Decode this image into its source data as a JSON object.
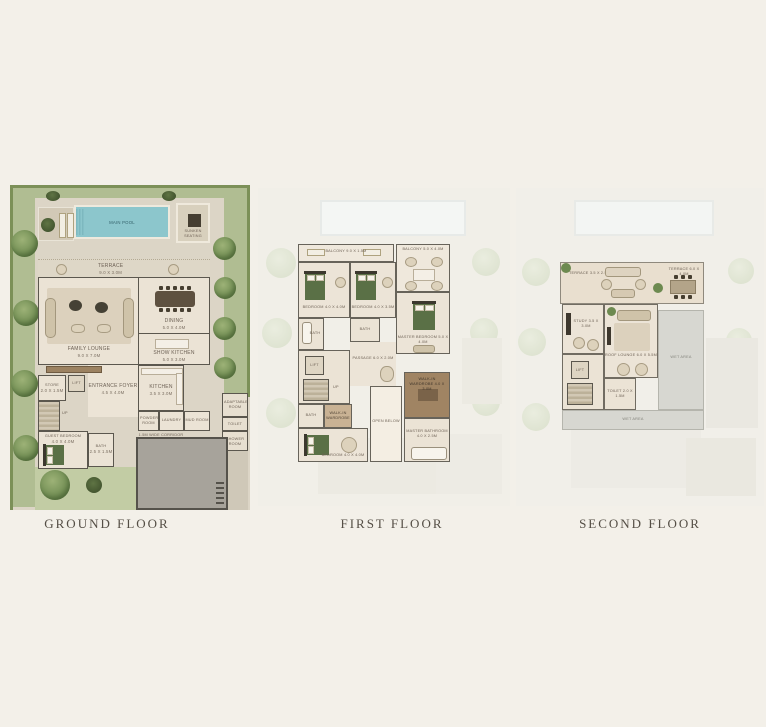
{
  "page": {
    "background": "#f3f0e9"
  },
  "captions": {
    "ground": "GROUND FLOOR",
    "first": "FIRST FLOOR",
    "second": "SECOND FLOOR"
  },
  "palette": {
    "background": "#f3f0e9",
    "pool": "#8cc6cc",
    "grass": "#b0bd92",
    "hedge": "#7c9058",
    "wall": "#5b574e",
    "floor": "#ebe3d5",
    "bed_green": "#5a7046",
    "garage": "#a7a39b",
    "wet_area": "#d7d7d1",
    "label": "#6d6155",
    "caption": "#544e45",
    "wardrobe_brown": "#9c8261"
  },
  "ground": {
    "labels": {
      "main_pool": "MAIN POOL",
      "sunken_seating": "SUNKEN SEATING",
      "terrace": "TERRACE",
      "terrace_dim": "9.0 x 3.0M",
      "family_lounge": "FAMILY LOUNGE",
      "family_lounge_dim": "9.0 x 7.0M",
      "dining": "DINING",
      "dining_dim": "5.0 x 4.0M",
      "show_kitchen": "SHOW KITCHEN",
      "show_kitchen_dim": "5.0 x 3.0M",
      "entrance_foyer": "ENTRANCE FOYER",
      "entrance_foyer_dim": "4.5 x 4.0M",
      "store": "STORE",
      "store_dim": "2.0 x 1.5M",
      "lift": "LIFT",
      "guest_bedroom": "GUEST BEDROOM",
      "guest_bedroom_dim": "4.0 x 4.0M",
      "bath": "BATH",
      "bath_dim": "2.5 x 1.5M",
      "kitchen": "KITCHEN",
      "kitchen_dim": "3.5 x 3.0M",
      "powder_room": "POWDER ROOM",
      "laundry": "LAUNDRY",
      "mud_room": "MUD ROOM",
      "corridor": "1.5M WIDE CORRIDOR",
      "adaptable_room": "ADAPTABLE ROOM",
      "toilet": "TOILET",
      "shower_room": "SHOWER ROOM",
      "up": "UP"
    }
  },
  "first": {
    "labels": {
      "balcony_left": "BALCONY",
      "balcony_left_dim": "9.0 x 1.5M",
      "balcony_right": "BALCONY",
      "balcony_right_dim": "5.0 x 4.0M",
      "bedroom_1": "BEDROOM",
      "bedroom_1_dim": "4.0 x 4.0M",
      "bedroom_2": "BEDROOM",
      "bedroom_2_dim": "4.0 x 3.5M",
      "master_bedroom": "MASTER BEDROOM",
      "master_bedroom_dim": "5.0 x 4.0M",
      "bath_1": "BATH",
      "bath_2": "BATH",
      "bath_3": "BATH",
      "passage": "PASSAGE",
      "passage_dim": "6.0 x 2.0M",
      "lift": "LIFT",
      "walk_in_wardrobe": "WALK-IN WARDROBE",
      "open_below": "OPEN BELOW",
      "master_wardrobe": "WALK-IN WARDROBE",
      "master_wardrobe_dim": "4.0 x 3.0M",
      "master_bathroom": "MASTER BATHROOM",
      "master_bathroom_dim": "4.0 x 2.5M",
      "bedroom_3": "BEDROOM",
      "bedroom_3_dim": "4.0 x 4.0M",
      "up": "UP"
    }
  },
  "second": {
    "labels": {
      "terrace_left": "TERRACE",
      "terrace_left_dim": "3.5 x 2.5M",
      "terrace_right": "TERRACE",
      "terrace_right_dim": "6.0 x 4.0M",
      "study": "STUDY",
      "study_dim": "3.5 x 3.0M",
      "roof_lounge": "ROOF LOUNGE",
      "roof_lounge_dim": "6.0 x 5.5M",
      "lift": "LIFT",
      "toilet": "TOILET",
      "toilet_dim": "2.0 x 1.5M",
      "wet_area_right": "WET AREA",
      "wet_area_bottom": "WET AREA"
    }
  }
}
